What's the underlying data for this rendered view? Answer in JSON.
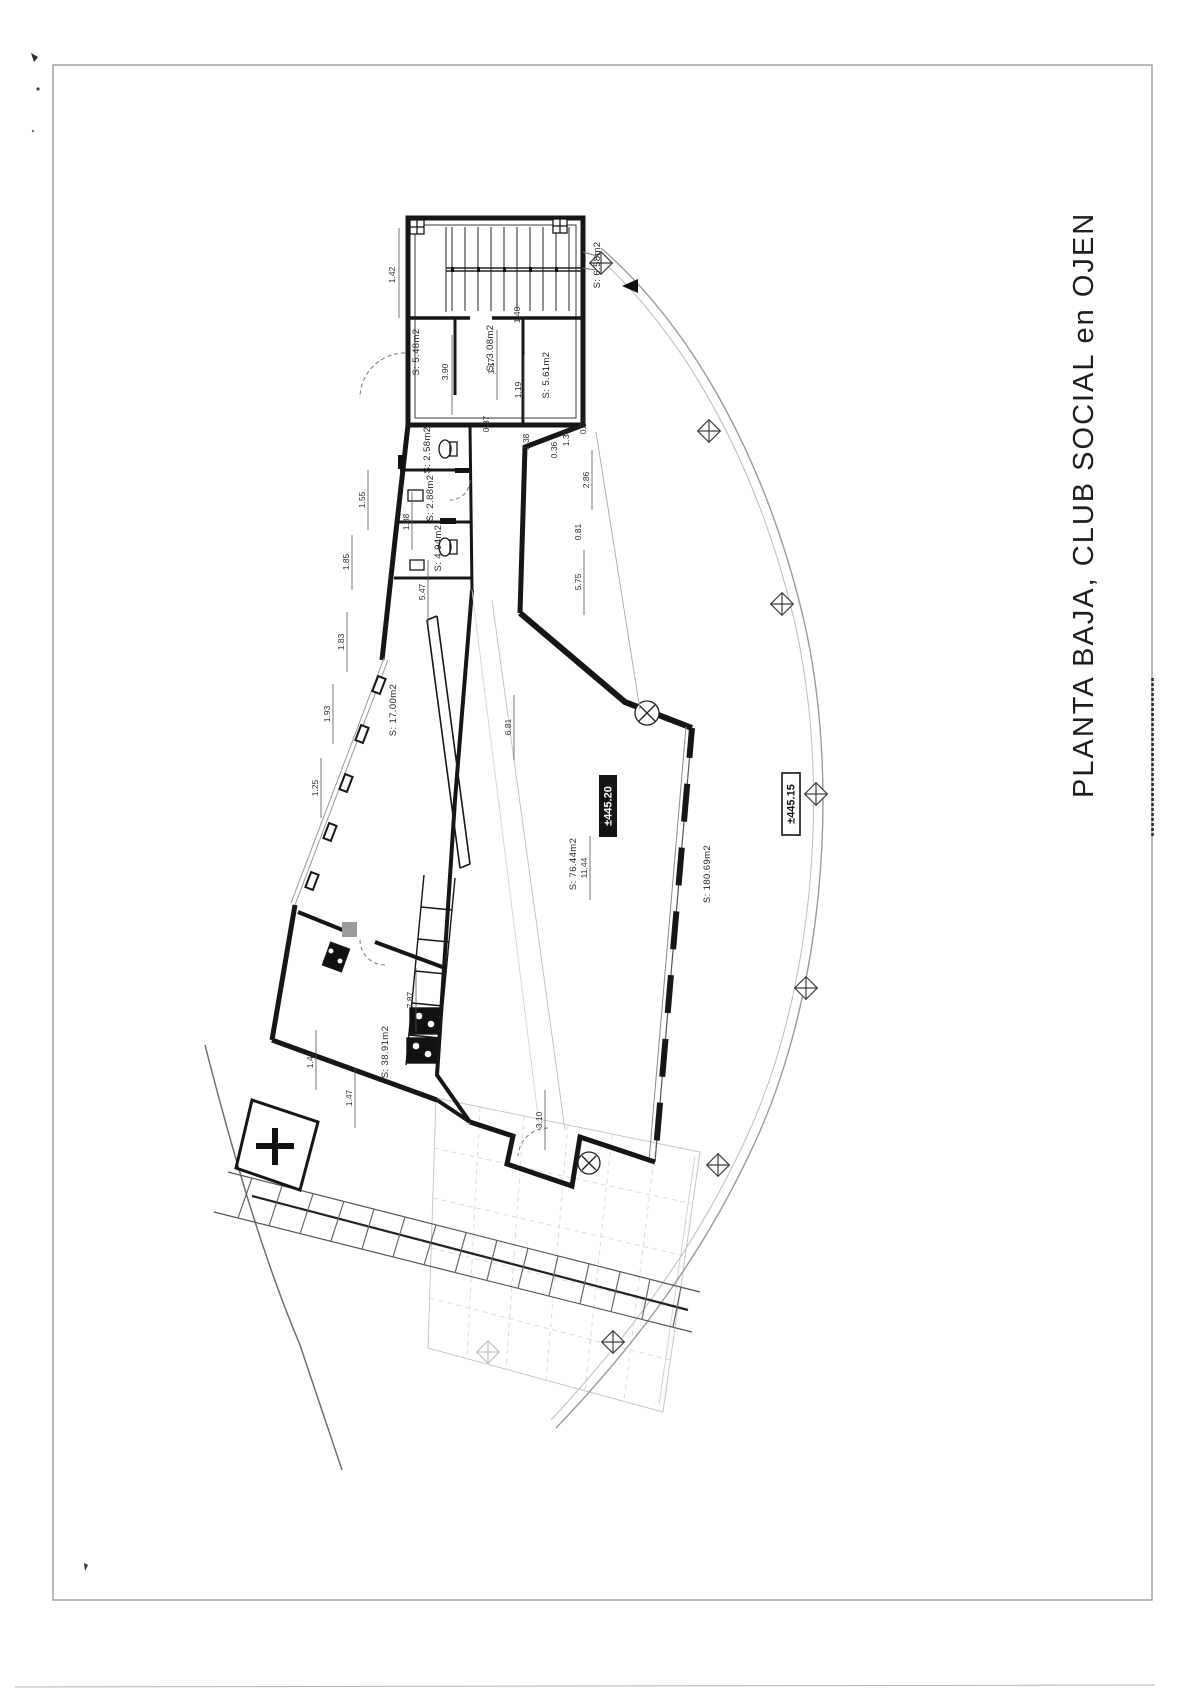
{
  "page": {
    "title": "PLANTA BAJA, CLUB SOCIAL en OJEN",
    "ink_color": "#1a1a1a",
    "faint_color": "#c9c9c9"
  },
  "plan": {
    "levels": [
      {
        "text": "±445.20",
        "style": "filled"
      },
      {
        "text": "±445.15",
        "style": "outlined"
      }
    ],
    "rooms": [
      "S: 5.48m2",
      "S: 3.08m2",
      "S: 6.58m2",
      "S: 5.61m2",
      "S: 2.58m2",
      "S: 2.88m2",
      "S: 4.94m2",
      "S: 17.00m2",
      "S: 76.44m2",
      "S: 180.69m2",
      "S: 38.91m2"
    ],
    "dimensions": [
      "1.42",
      "3.90",
      "1.40",
      "1.17",
      "1.19",
      "0.37",
      "1.38",
      "0.84",
      "1.55",
      "1.88",
      "1.85",
      "5.47",
      "2.86",
      "0.81",
      "1.83",
      "1.93",
      "1.25",
      "1.47",
      "1.41",
      "7.87",
      "11.44",
      "3.10",
      "6.81",
      "5.75",
      "0.36",
      "1.34"
    ]
  }
}
